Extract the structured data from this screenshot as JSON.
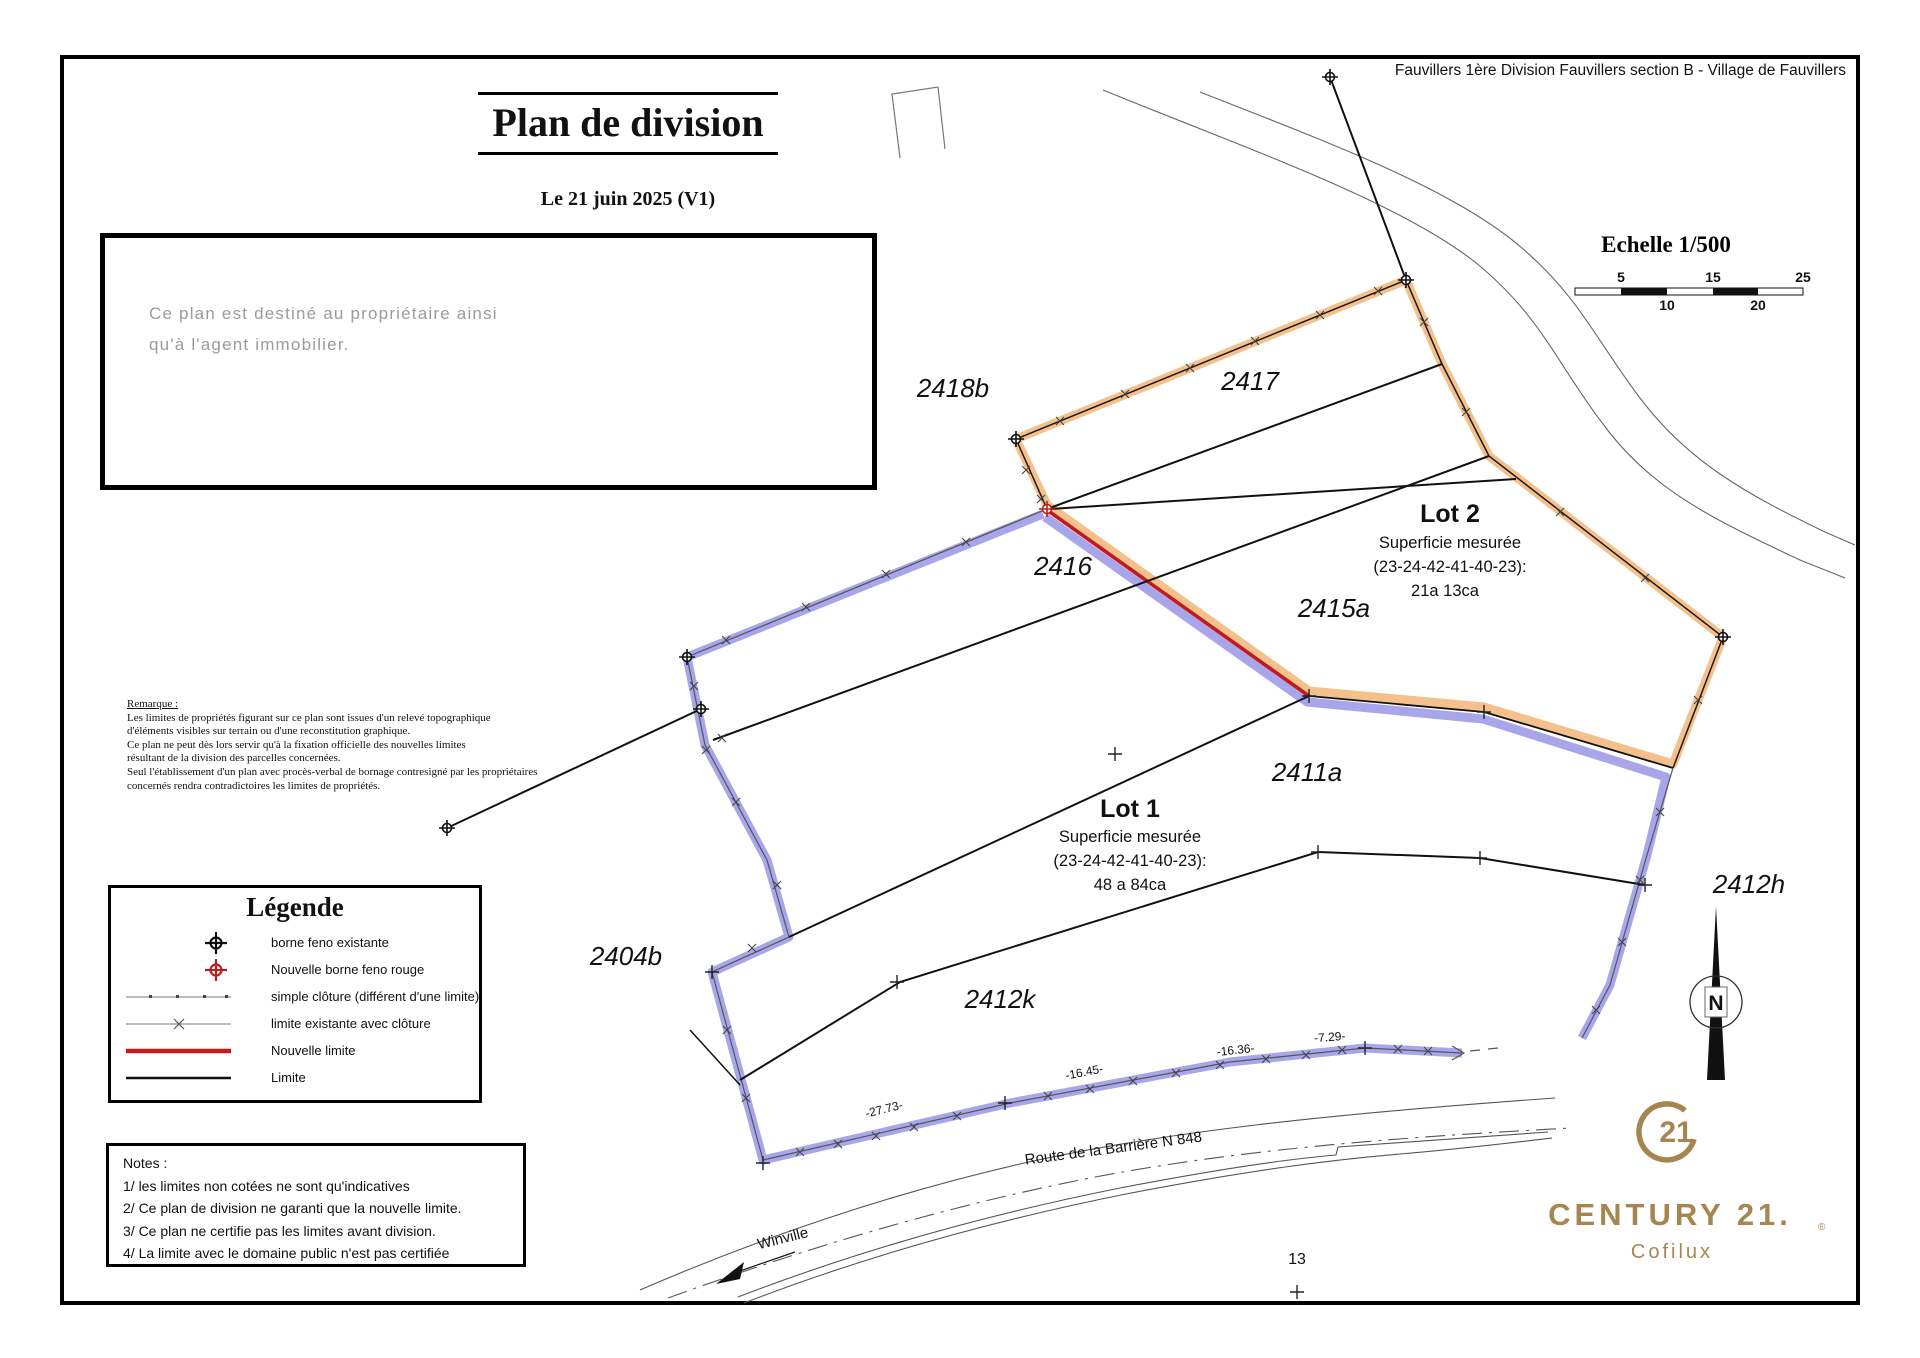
{
  "page": {
    "title": "Plan de division",
    "date": "Le 21 juin 2025 (V1)",
    "location_header": "Fauvillers 1ère Division Fauvillers section B - Village de Fauvillers"
  },
  "info_box": {
    "line1": "Ce plan est destiné au propriétaire ainsi",
    "line2": "qu'à l'agent immobilier."
  },
  "remark": {
    "title": "Remarque :",
    "lines": [
      "Les limites de propriétés figurant sur ce plan sont issues d'un relevé topographique",
      "d'éléments visibles sur terrain ou d'une reconstitution graphique.",
      "Ce plan ne peut dès lors servir qu'à la fixation officielle des nouvelles limites",
      "résultant de la division des parcelles concernées.",
      "Seul l'établissement d'un plan avec procès-verbal de bornage contresigné par les propriétaires",
      "concernés rendra contradictoires les limites de propriétés."
    ]
  },
  "legend": {
    "title": "Légende",
    "items": [
      {
        "symbol": "existing-borne-icon",
        "label": "borne feno existante"
      },
      {
        "symbol": "new-borne-icon",
        "label": "Nouvelle borne feno rouge"
      },
      {
        "symbol": "simple-fence-line",
        "label": "simple clôture (différent d'une limite)"
      },
      {
        "symbol": "existing-limit-fence-line",
        "label": "limite existante avec clôture"
      },
      {
        "symbol": "new-limit-line",
        "label": "Nouvelle limite"
      },
      {
        "symbol": "limit-line",
        "label": "Limite"
      }
    ]
  },
  "notes": {
    "title": "Notes :",
    "lines": [
      "1/ les limites non cotées ne sont qu'indicatives",
      "2/ Ce plan de division ne garanti que la nouvelle limite.",
      "3/ Ce plan ne certifie pas les limites avant division.",
      "4/ La limite avec le domaine public n'est pas certifiée"
    ]
  },
  "scale": {
    "label": "Echelle 1/500",
    "above": [
      "5",
      "15",
      "25"
    ],
    "below": [
      "10",
      "20"
    ]
  },
  "lots": {
    "lot2": {
      "name": "Lot 2",
      "subtitle": "Superficie mesurée",
      "points": "(23-24-42-41-40-23):",
      "area": "21a 13ca"
    },
    "lot1": {
      "name": "Lot 1",
      "subtitle": "Superficie mesurée",
      "points": "(23-24-42-41-40-23):",
      "area": "48 a 84ca"
    }
  },
  "parcels": {
    "p2418b": "2418b",
    "p2417": "2417",
    "p2416": "2416",
    "p2415a": "2415a",
    "p2411a": "2411a",
    "p2404b": "2404b",
    "p2412k": "2412k",
    "p2412h": "2412h"
  },
  "measurements": {
    "m1": "-27.73-",
    "m2": "-16.45-",
    "m3": "-16.36-",
    "m4": "-7.29-",
    "point": "13"
  },
  "road": {
    "name": "Route de la Barrière N 848",
    "direction": "Winville"
  },
  "compass": {
    "north": "N"
  },
  "logo": {
    "mark": "21",
    "brand": "CENTURY 21.",
    "registered": "®",
    "agency": "Cofilux"
  },
  "colors": {
    "lot2_band": "#F4C08C",
    "lot1_band": "#A9A5EA",
    "new_limit": "#C21A1C",
    "new_borne": "#B22222",
    "brand_gold": "#A6854F"
  }
}
